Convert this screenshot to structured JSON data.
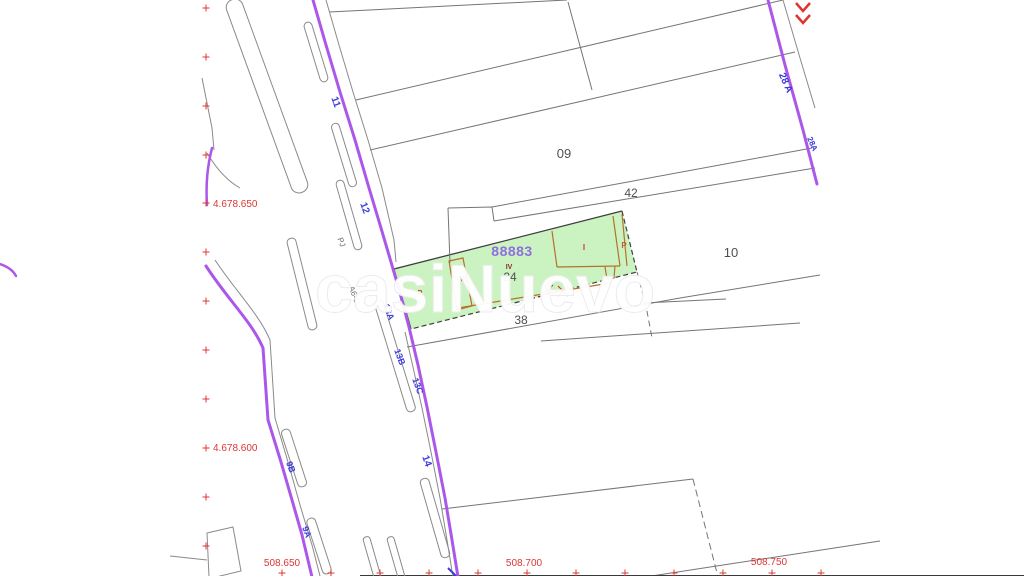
{
  "title": "Cadastral parcel map",
  "watermark": "casiNuevo",
  "colors": {
    "road_accent": "#ab58ea",
    "parcel_line": "#757575",
    "curb_line": "#8a8a8a",
    "highlight_fill": "#cbf3c2",
    "highlight_border": "#3f3f3f",
    "building_line": "#b5712c",
    "street_label": "#3a3ae0",
    "coord_label": "#e03434",
    "ref_label": "#8f6ede",
    "parcel_label": "#4f4f4f"
  },
  "labels": {
    "parcel_ref": {
      "text": "88883",
      "x": 512,
      "y": 256,
      "size": 14
    },
    "floors": {
      "text": "IV",
      "x": 509,
      "y": 269,
      "size": 7
    },
    "parcels": [
      {
        "text": "09",
        "x": 564,
        "y": 158,
        "size": 13
      },
      {
        "text": "42",
        "x": 631,
        "y": 197,
        "size": 12
      },
      {
        "text": "10",
        "x": 731,
        "y": 257,
        "size": 13
      },
      {
        "text": "38",
        "x": 521,
        "y": 324,
        "size": 12
      },
      {
        "text": "24",
        "x": 510,
        "y": 281,
        "size": 12
      }
    ],
    "streets": [
      {
        "text": "11",
        "x": 333,
        "y": 103,
        "rot": 70,
        "size": 10
      },
      {
        "text": "12",
        "x": 362,
        "y": 209,
        "rot": 70,
        "size": 10
      },
      {
        "text": "13A",
        "x": 386,
        "y": 313,
        "rot": 70,
        "size": 9
      },
      {
        "text": "13B",
        "x": 397,
        "y": 358,
        "rot": 70,
        "size": 9
      },
      {
        "text": "13C",
        "x": 415,
        "y": 387,
        "rot": 70,
        "size": 9
      },
      {
        "text": "14",
        "x": 424,
        "y": 462,
        "rot": 70,
        "size": 10
      },
      {
        "text": "9B",
        "x": 288,
        "y": 468,
        "rot": 70,
        "size": 9
      },
      {
        "text": "9A",
        "x": 304,
        "y": 533,
        "rot": 70,
        "size": 9
      },
      {
        "text": "28 A",
        "x": 783,
        "y": 84,
        "rot": 66,
        "size": 10
      },
      {
        "text": "28A",
        "x": 810,
        "y": 145,
        "rot": 66,
        "size": 8
      }
    ],
    "ways": [
      {
        "text": "PJ",
        "x": 339,
        "y": 243,
        "rot": 70,
        "size": 8
      },
      {
        "text": "A6-O",
        "x": 352,
        "y": 296,
        "rot": 70,
        "size": 8
      }
    ],
    "uses": [
      {
        "text": "P",
        "x": 420,
        "y": 295,
        "size": 7,
        "color": "#d03828"
      },
      {
        "text": "OR",
        "x": 462,
        "y": 282,
        "size": 7,
        "color": "#d03828"
      },
      {
        "text": "I",
        "x": 584,
        "y": 250,
        "size": 8,
        "color": "#d03828"
      },
      {
        "text": "P",
        "x": 624,
        "y": 248,
        "size": 8,
        "color": "#c06030"
      }
    ],
    "coords": [
      {
        "text": "4.678.650",
        "x": 213,
        "y": 207,
        "anchor": "start"
      },
      {
        "text": "4.678.600",
        "x": 213,
        "y": 451,
        "anchor": "start"
      },
      {
        "text": "508.650",
        "x": 282,
        "y": 566,
        "anchor": "middle"
      },
      {
        "text": "508.700",
        "x": 524,
        "y": 566,
        "anchor": "middle"
      },
      {
        "text": "508.750",
        "x": 769,
        "y": 565,
        "anchor": "middle"
      }
    ]
  },
  "grid": {
    "left_column_x": 206,
    "left_column_ys": [
      8,
      57,
      106,
      155,
      203,
      252,
      301,
      350,
      399,
      448,
      497,
      546
    ],
    "bottom_row_y": 573,
    "bottom_row_xs": [
      282,
      331,
      380,
      429,
      478,
      527,
      576,
      625,
      674,
      723,
      772,
      821
    ]
  }
}
